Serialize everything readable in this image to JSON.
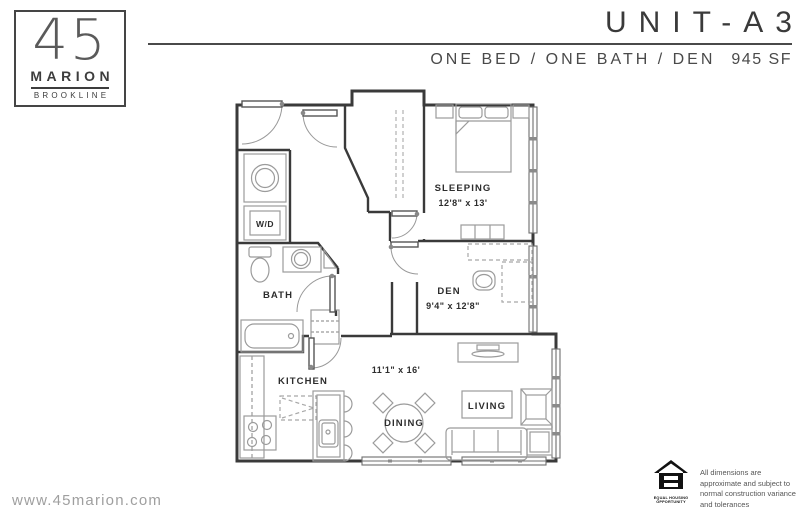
{
  "header": {
    "logo": {
      "number": "45",
      "name": "MARION",
      "city": "BROOKLINE"
    },
    "unit_title": "UNIT-A3",
    "subtitle": "ONE BED / ONE BATH / DEN",
    "area": "945 SF"
  },
  "rooms": {
    "sleeping": {
      "label": "SLEEPING",
      "dims": "12'8\" x 13'"
    },
    "den": {
      "label": "DEN",
      "dims": "9'4\" x 12'8\""
    },
    "bath": {
      "label": "BATH"
    },
    "kitchen": {
      "label": "KITCHEN"
    },
    "dining": {
      "label": "DINING"
    },
    "living": {
      "label": "LIVING"
    },
    "laundry": {
      "label": "W/D"
    },
    "great_room": {
      "dims": "11'1\" x 16'"
    }
  },
  "footer": {
    "website": "www.45marion.com",
    "eho_label_top": "EQUAL HOUSING",
    "eho_label_bottom": "OPPORTUNITY",
    "disclaimer": "All dimensions are approximate and subject to normal construction variance and tolerances"
  },
  "colors": {
    "ink": "#3a3a3a",
    "furniture_gray": "#9b9b9b",
    "muted_text": "#9f9f9f"
  }
}
